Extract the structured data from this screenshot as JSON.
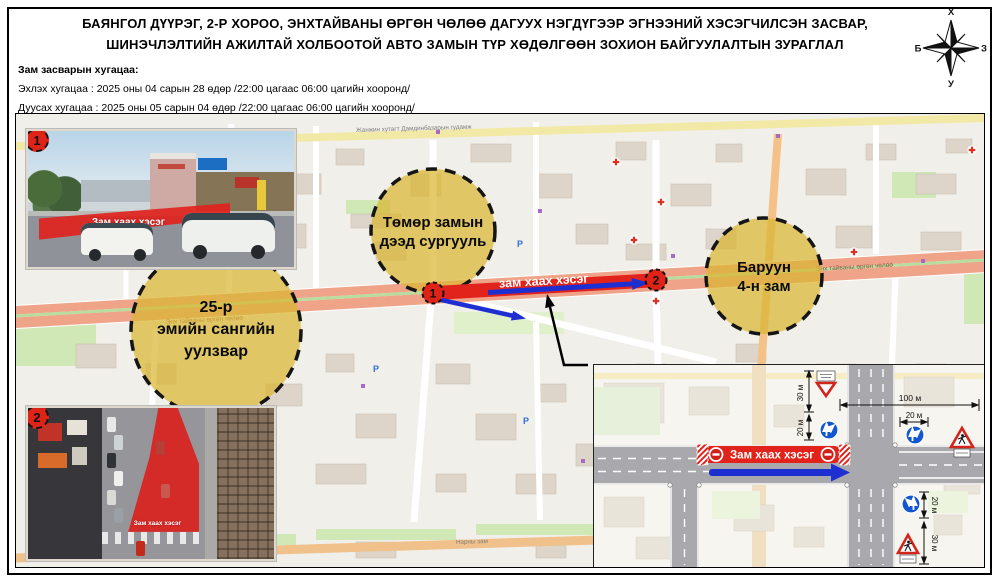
{
  "header": {
    "title_line1": "БАЯНГОЛ ДҮҮРЭГ, 2-Р ХОРОО, ЭНХТАЙВАНЫ ӨРГӨН ЧӨЛӨӨ ДАГУУХ НЭГДҮГЭЭР ЭГНЭЭНИЙ ХЭСЭГЧИЛСЭН ЗАСВАР,",
    "title_line2": "ШИНЭЧЛЭЛТИЙН АЖИЛТАЙ ХОЛБООТОЙ АВТО ЗАМЫН ТҮР ХӨДӨЛГӨӨН ЗОХИОН БАЙГУУЛАЛТЫН ЗУРАГЛАЛ"
  },
  "compass": {
    "north": "Х",
    "east": "З",
    "south": "У",
    "west": "Б"
  },
  "schedule": {
    "heading": "Зам засварын хугацаа:",
    "start": "Эхлэх хугацаа : 2025 оны 04 сарын 28 өдөр /22:00 цагаас 06:00 цагийн хооронд/",
    "end": "Дуусах хугацаа : 2025 оны 05 сарын 04 өдөр /22:00 цагаас 06:00 цагийн хооронд/"
  },
  "map": {
    "closure_label": "зам хаах хэсэг",
    "marker1": "1",
    "marker2": "2",
    "circle1": {
      "line1": "25-р",
      "line2": "эмийн сангийн",
      "line3": "уулзвар"
    },
    "circle2": {
      "line1": "Төмөр замын",
      "line2": "дээд сургууль"
    },
    "circle3": {
      "line1": "Баруун",
      "line2": "4-н зам"
    },
    "streets": {
      "peace_avenue": "Энх тайваны өргөн чөлөө",
      "naran_road": "Нарны зам",
      "damdinbazar": "Жанжин хутагт Дамдинбазарын гудамж"
    },
    "parking_label": "P"
  },
  "photo1": {
    "marker": "1",
    "label": "Зам хаах хэсэг"
  },
  "photo2": {
    "marker": "2",
    "label": "Зам хаах хэсэг"
  },
  "diagram": {
    "closure_label": "Зам хаах хэсэг",
    "m30": "30 м",
    "m20": "20 м",
    "m100": "100 м"
  },
  "colors": {
    "closure_red": "#E2231C",
    "arrow_blue": "#1E2FD2",
    "circle_yellow": "#D9B636",
    "avenue_salmon": "#EFA48A"
  }
}
